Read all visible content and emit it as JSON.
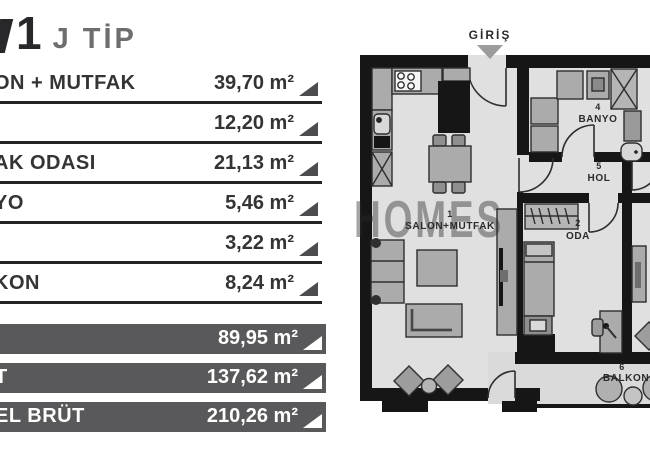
{
  "left_panel": {
    "title": {
      "number": "1",
      "suffix": "J TİP"
    },
    "rows": [
      {
        "label": "ON + MUTFAK",
        "area": "39,70 m²"
      },
      {
        "label": "",
        "area": "12,20 m²"
      },
      {
        "label": "AK ODASI",
        "area": "21,13 m²"
      },
      {
        "label": "YO",
        "area": "5,46 m²"
      },
      {
        "label": "",
        "area": "3,22 m²"
      },
      {
        "label": "KON",
        "area": "8,24 m²"
      }
    ],
    "totals": [
      {
        "label": "",
        "area": "89,95 m²"
      },
      {
        "label": "T",
        "area": "137,62 m²"
      },
      {
        "label": "EL BRÜT",
        "area": "210,26 m²"
      }
    ],
    "colors": {
      "row_text": "#343436",
      "bar_background": "#59595b",
      "triangle": "#4c4c50"
    }
  },
  "floor_plan": {
    "entrance_label": "GİRİŞ",
    "watermark": "HOMES",
    "rooms": [
      {
        "number": "1",
        "name": "SALON+MUTFAK"
      },
      {
        "number": "2",
        "name": "ODA"
      },
      {
        "number": "4",
        "name": "BANYO"
      },
      {
        "number": "5",
        "name": "HOL"
      },
      {
        "number": "6",
        "name": "BALKON"
      }
    ],
    "colors": {
      "wall": "#161616",
      "floor": "#e0e0e0",
      "furniture": "#ababab"
    }
  }
}
